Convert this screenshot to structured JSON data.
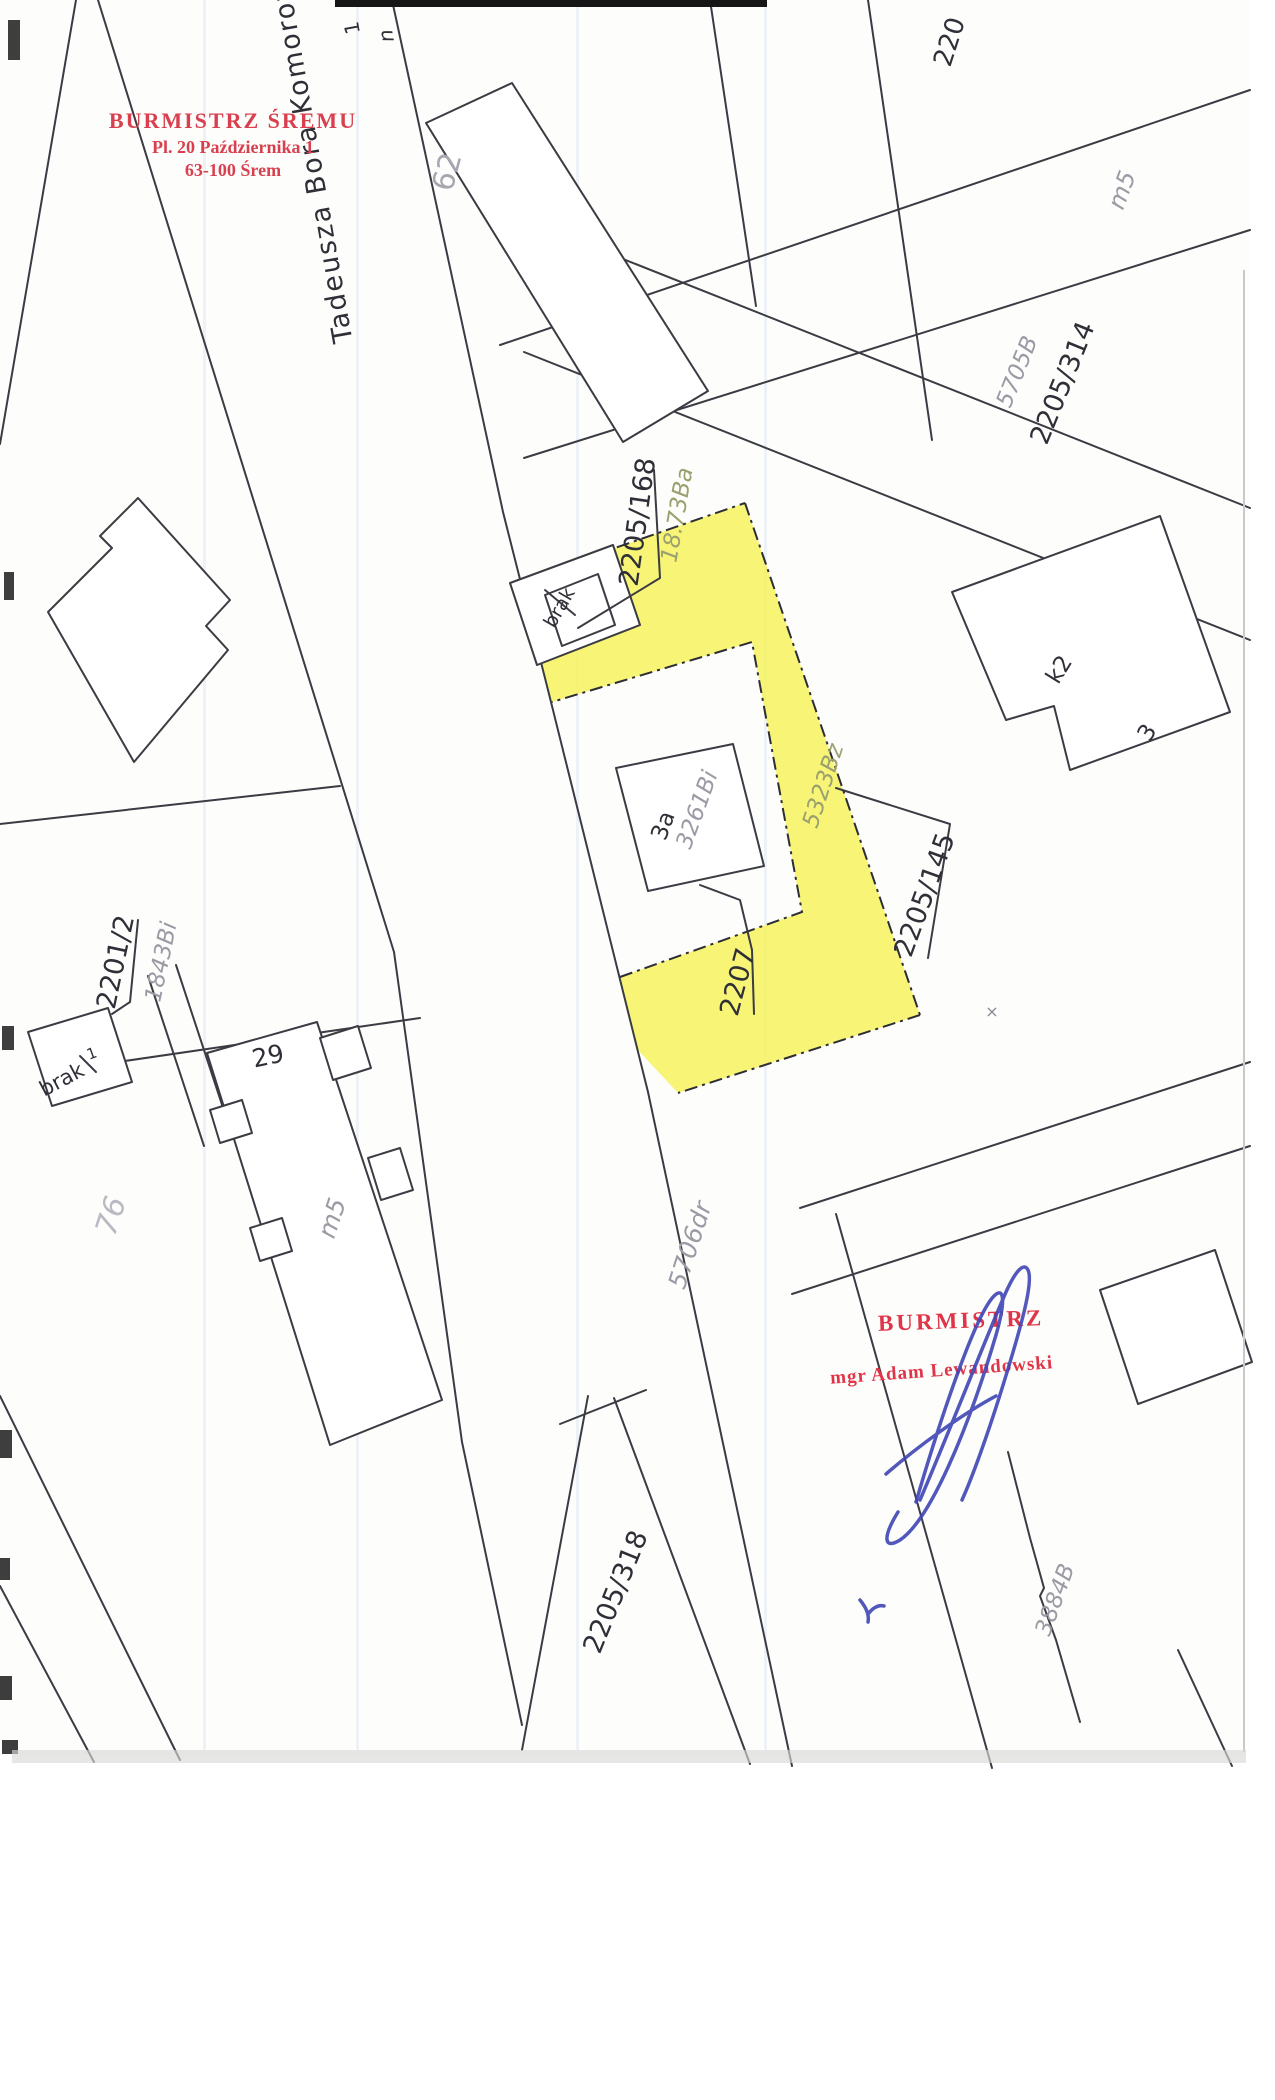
{
  "document": {
    "type": "cadastral-map-scan",
    "highlight_color": "#f6f355",
    "ink_color": "#2f2f38",
    "muted_label_color": "#9b9ba6",
    "stamp_color": "#d8404f",
    "signature_color": "#3f46b5"
  },
  "stamp_top": {
    "line1": "BURMISTRZ ŚREMU",
    "line2": "Pl. 20 Października 1",
    "line3": "63-100 Śrem"
  },
  "stamp_bottom": {
    "title": "BURMISTRZ",
    "name": "mgr Adam Lewandowski"
  },
  "street": {
    "name": "Tadeusza Bora Komorow"
  },
  "labels": {
    "edge_1": "1",
    "edge_n": "n",
    "building_62": "62",
    "parcel_220": "220",
    "m5_top": "m5",
    "code_5705B": "5705B",
    "parcel_2205_314": "2205/314",
    "parcel_2205_168": "2205/168",
    "code_1873Ba": "18.73Ba",
    "brak_top": "brak",
    "building_3a": "3a",
    "code_3261Bi": "3261Bi",
    "code_5323Bz": "5323Bz",
    "parcel_2205_145": "2205/145",
    "parcel_2201_2": "2201/2",
    "code_1843Bi": "1843Bi",
    "brak_left": "brak",
    "brak_left_mark": "1",
    "code_76": "76",
    "building_29": "29",
    "m5_bottom": "m5",
    "parcel_2207": "2207",
    "code_5706dr": "5706dr",
    "parcel_2205_318": "2205/318",
    "code_3884B": "3884B",
    "building_k2": "k2",
    "building_3": "3",
    "cross_mark": "×"
  }
}
